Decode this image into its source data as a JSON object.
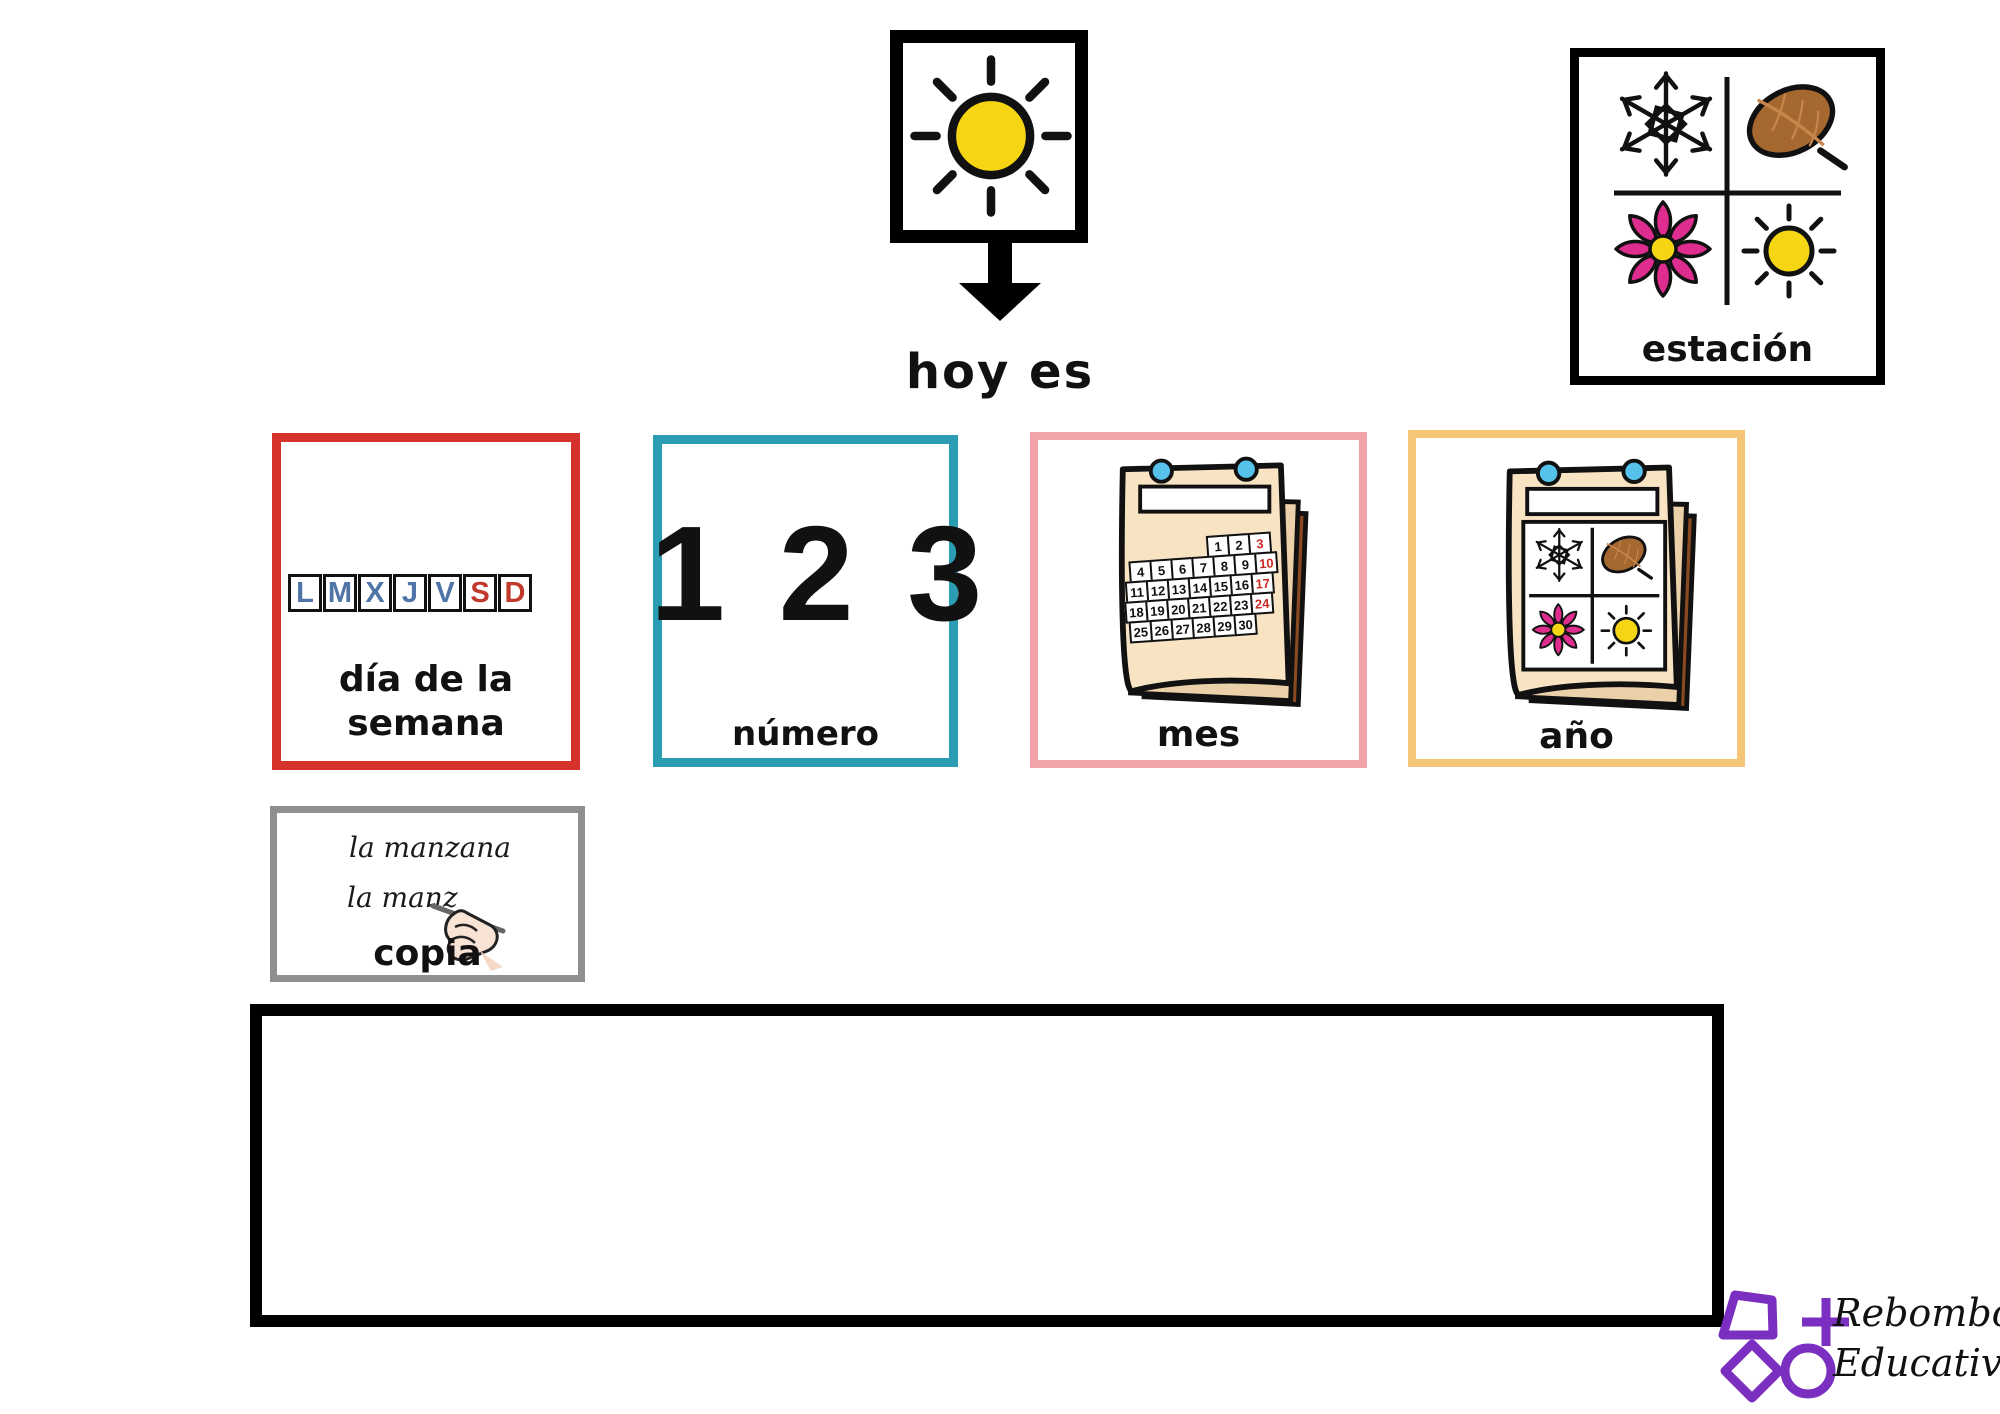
{
  "page": {
    "today_label": "hoy es",
    "header_icon": "sun-icon"
  },
  "season_card": {
    "label": "estación",
    "icons": [
      "snowflake",
      "autumn-leaf",
      "poinsettia-flower",
      "sun"
    ]
  },
  "day_card": {
    "label_line1": "día de la",
    "label_line2": "semana",
    "week_letters": [
      {
        "ch": "L",
        "color": "blue"
      },
      {
        "ch": "M",
        "color": "blue"
      },
      {
        "ch": "X",
        "color": "blue"
      },
      {
        "ch": "J",
        "color": "blue"
      },
      {
        "ch": "V",
        "color": "blue"
      },
      {
        "ch": "S",
        "color": "red"
      },
      {
        "ch": "D",
        "color": "red"
      }
    ]
  },
  "number_card": {
    "digits": "1 2 3",
    "label": "número"
  },
  "month_card": {
    "label": "mes",
    "calendar_rows": [
      [
        "1",
        "2",
        "3"
      ],
      [
        "4",
        "5",
        "6",
        "7",
        "8",
        "9",
        "10"
      ],
      [
        "11",
        "12",
        "13",
        "14",
        "15",
        "16",
        "17"
      ],
      [
        "18",
        "19",
        "20",
        "21",
        "22",
        "23",
        "24"
      ],
      [
        "25",
        "26",
        "27",
        "28",
        "29",
        "30"
      ]
    ],
    "red_dates": [
      "3",
      "10",
      "17",
      "24"
    ],
    "icon": "tear-off-calendar"
  },
  "year_card": {
    "label": "año",
    "icon": "seasons-calendar",
    "panel_icons": [
      "snowflake",
      "autumn-leaf",
      "poinsettia-flower",
      "sun"
    ]
  },
  "copy_card": {
    "sample_line": "la manzana",
    "trace_line": "la manz",
    "label": "copia",
    "icon": "hand-writing"
  },
  "writing_area": {
    "content": ""
  },
  "logo": {
    "name_line1": "Rebombori",
    "name_line2": "Educativo"
  },
  "colors": {
    "day_border": "#d6322c",
    "number_border": "#2a9db3",
    "month_border": "#f2a3aa",
    "year_border": "#f5c678",
    "copy_border": "#8f8f8f",
    "letter_blue": "#4f74a8",
    "letter_red": "#c0392b",
    "date_red": "#cc2b24",
    "sun_yellow": "#f6d513",
    "flower_pink": "#de2c8f",
    "leaf_brown": "#a5682f",
    "pin_blue": "#56c1ea",
    "logo_purple": "#7a2fc0"
  }
}
